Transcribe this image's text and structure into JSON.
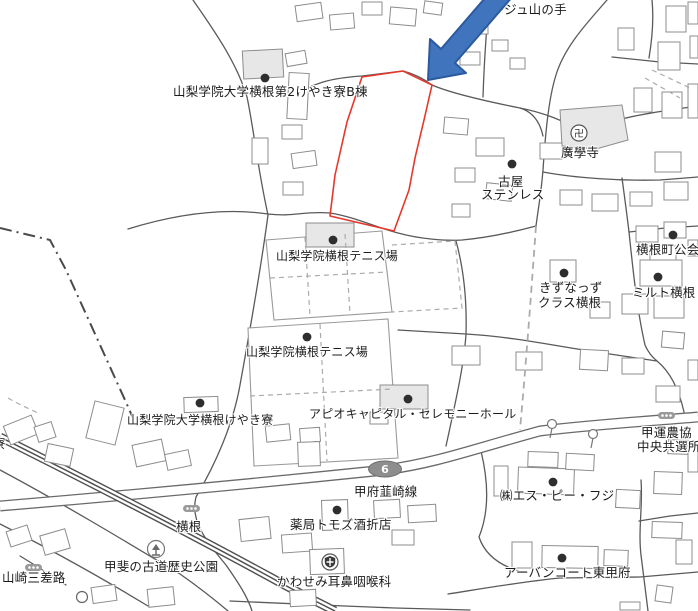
{
  "map": {
    "labels": {
      "lage_yamanote": "ラージュ山の手",
      "dorm_b": "山梨学院大学横根第2けやき寮B棟",
      "kogakuji": "廣學寺",
      "furuya_line1": "古屋",
      "furuya_line2": "ステンレス",
      "yokone_kokai": "横根町公会",
      "kizunazzu_line1": "きずなっず",
      "kizunazzu_line2": "クラス横根",
      "milt_yokone": "ミルト横根",
      "tennis_upper": "山梨学院横根テニス場",
      "tennis_lower": "山梨学院横根テニス場",
      "keyaki_dorm": "山梨学院大学横根けやき寮",
      "apio_hall": "アピオキャピタル・セレモニーホール",
      "route_name": "甲府韮崎線",
      "yokone_crossing": "横根",
      "pharmacy": "薬局トモズ酒折店",
      "kawasemi_clinic": "かわせみ耳鼻咽喉科",
      "sp_fuji": "㈱エス・ピー・フジ",
      "urban_court": "アーバンコート東甲府",
      "kouun_line1": "甲運農協",
      "kouun_line2": "中央共選所",
      "kaido_park": "甲斐の古道歴史公園",
      "yamazaki": "山崎三差路",
      "edge_partial": "寮"
    },
    "icons": {
      "temple_glyph": "卍",
      "route_badge_number": "6"
    },
    "colors": {
      "background": "#ffffff",
      "road": "#5a5a5a",
      "main_road_casing": "#6a6a6a",
      "railway": "#4f4f4f",
      "building_stroke": "#8c8c8c",
      "building_fill": "#ffffff",
      "building_shaded_fill": "#e7e7e7",
      "parcel_outline_red": "#e5382b",
      "arrow_fill": "#4074bd",
      "arrow_stroke": "#2b5a9f",
      "route_badge_fill": "#8e8e8e",
      "route_badge_text": "#ffffff",
      "label_text": "#1c1c1c"
    }
  }
}
